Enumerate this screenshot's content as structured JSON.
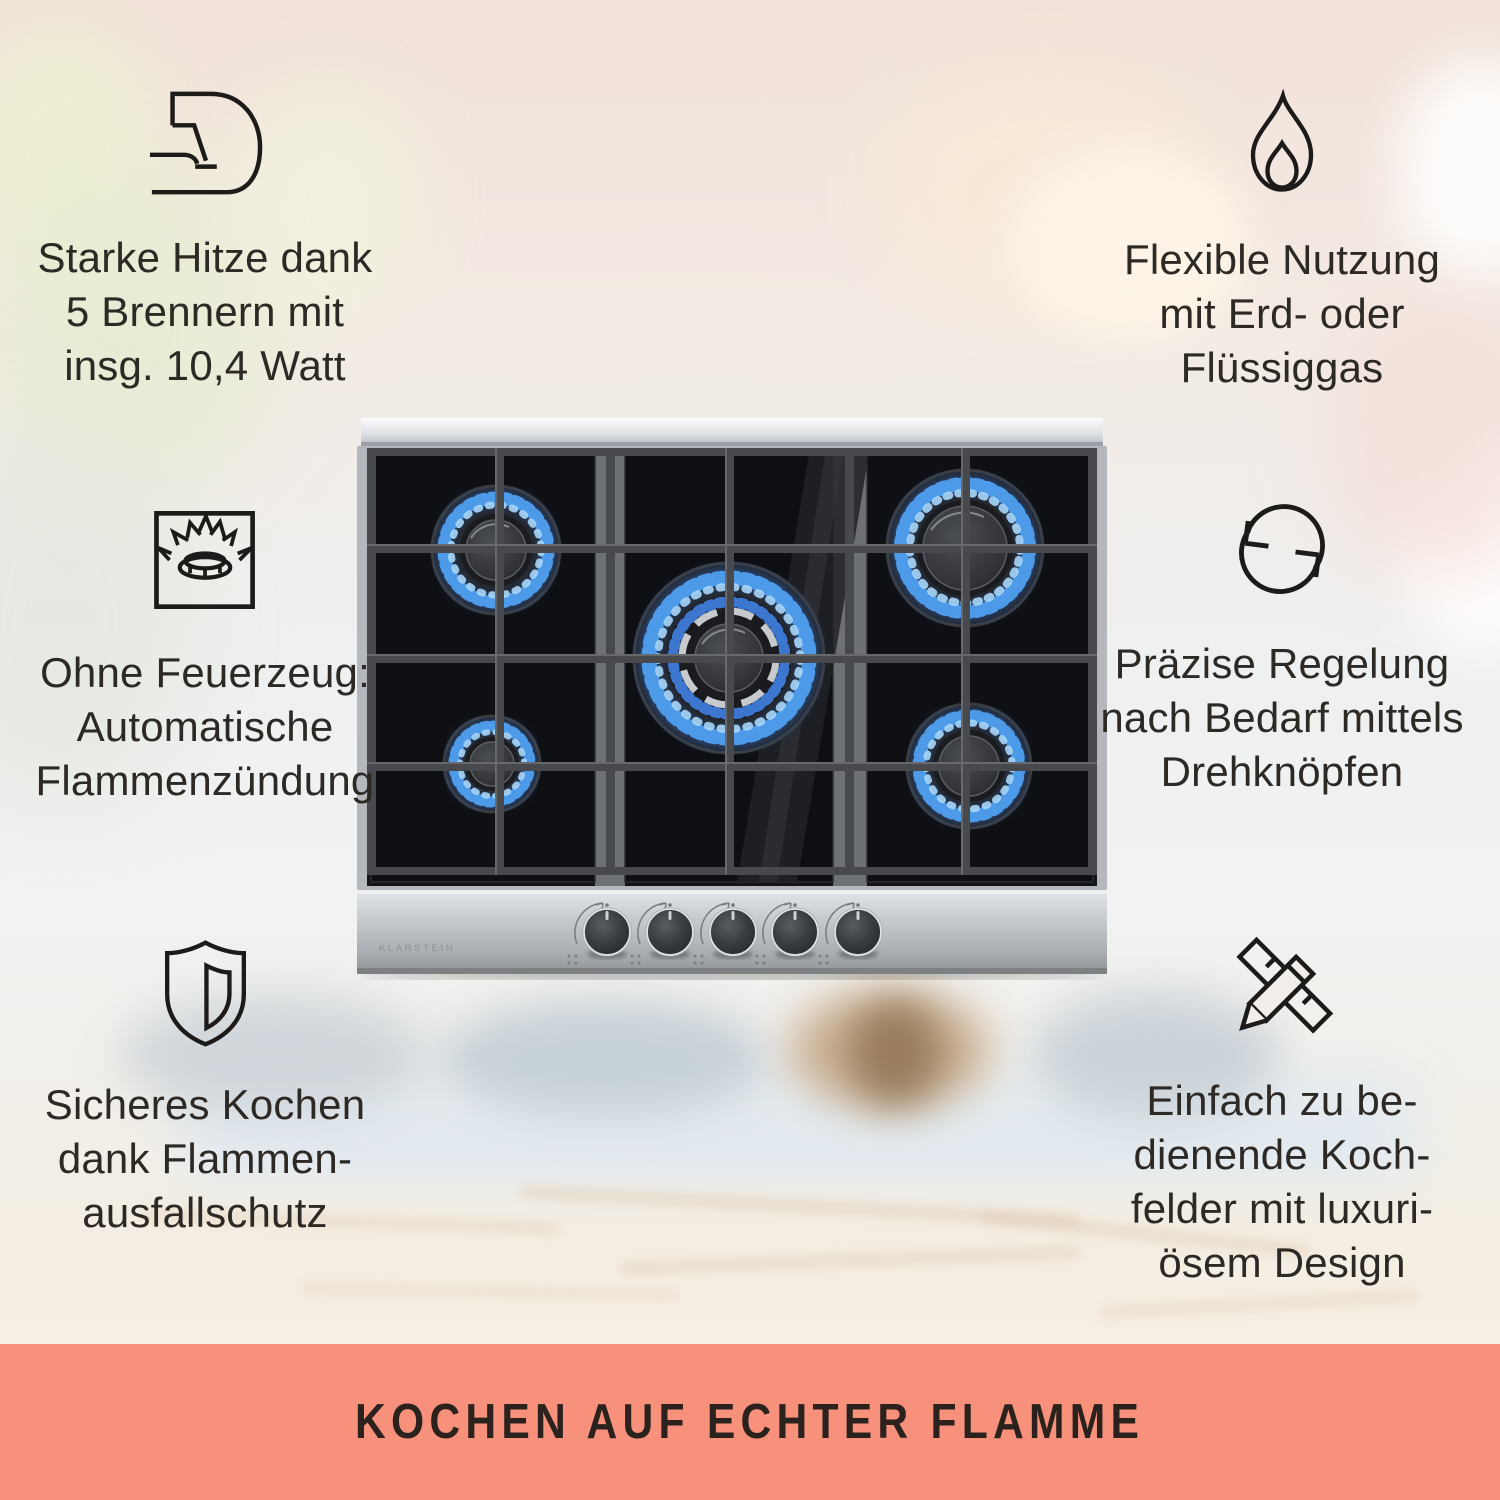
{
  "brand": {
    "panel_logo": "KLARSTEIN"
  },
  "features": {
    "top_left": {
      "icon": "flexed-arm-icon",
      "lines": [
        "Starke Hitze dank",
        "5 Brennern mit",
        "insg. 10,4 Watt"
      ]
    },
    "top_right": {
      "icon": "flame-icon",
      "lines": [
        "Flexible Nutzung",
        "mit Erd- oder",
        "Flüssiggas"
      ]
    },
    "middle_left": {
      "icon": "gas-burner-ignition-icon",
      "lines": [
        "Ohne Feuerzeug:",
        "Automatische",
        "Flammenzündung"
      ]
    },
    "middle_right": {
      "icon": "rotate-arrows-icon",
      "lines": [
        "Präzise Regelung",
        "nach Bedarf mittels",
        "Drehknöpfen"
      ]
    },
    "bottom_left": {
      "icon": "shield-icon",
      "lines": [
        "Sicheres Kochen",
        "dank Flammen-",
        "ausfallschutz"
      ]
    },
    "bottom_right": {
      "icon": "ruler-pencil-icon",
      "lines": [
        "Einfach zu be-",
        "dienende Koch-",
        "felder mit luxuri-",
        "ösem Design"
      ]
    }
  },
  "banner": {
    "headline": "KOCHEN AUF ECHTER FLAMME",
    "background_color": "#f7917b",
    "headline_color": "#2b221e"
  },
  "product": {
    "burners_visible": 5,
    "control_knobs_visible": 5
  }
}
